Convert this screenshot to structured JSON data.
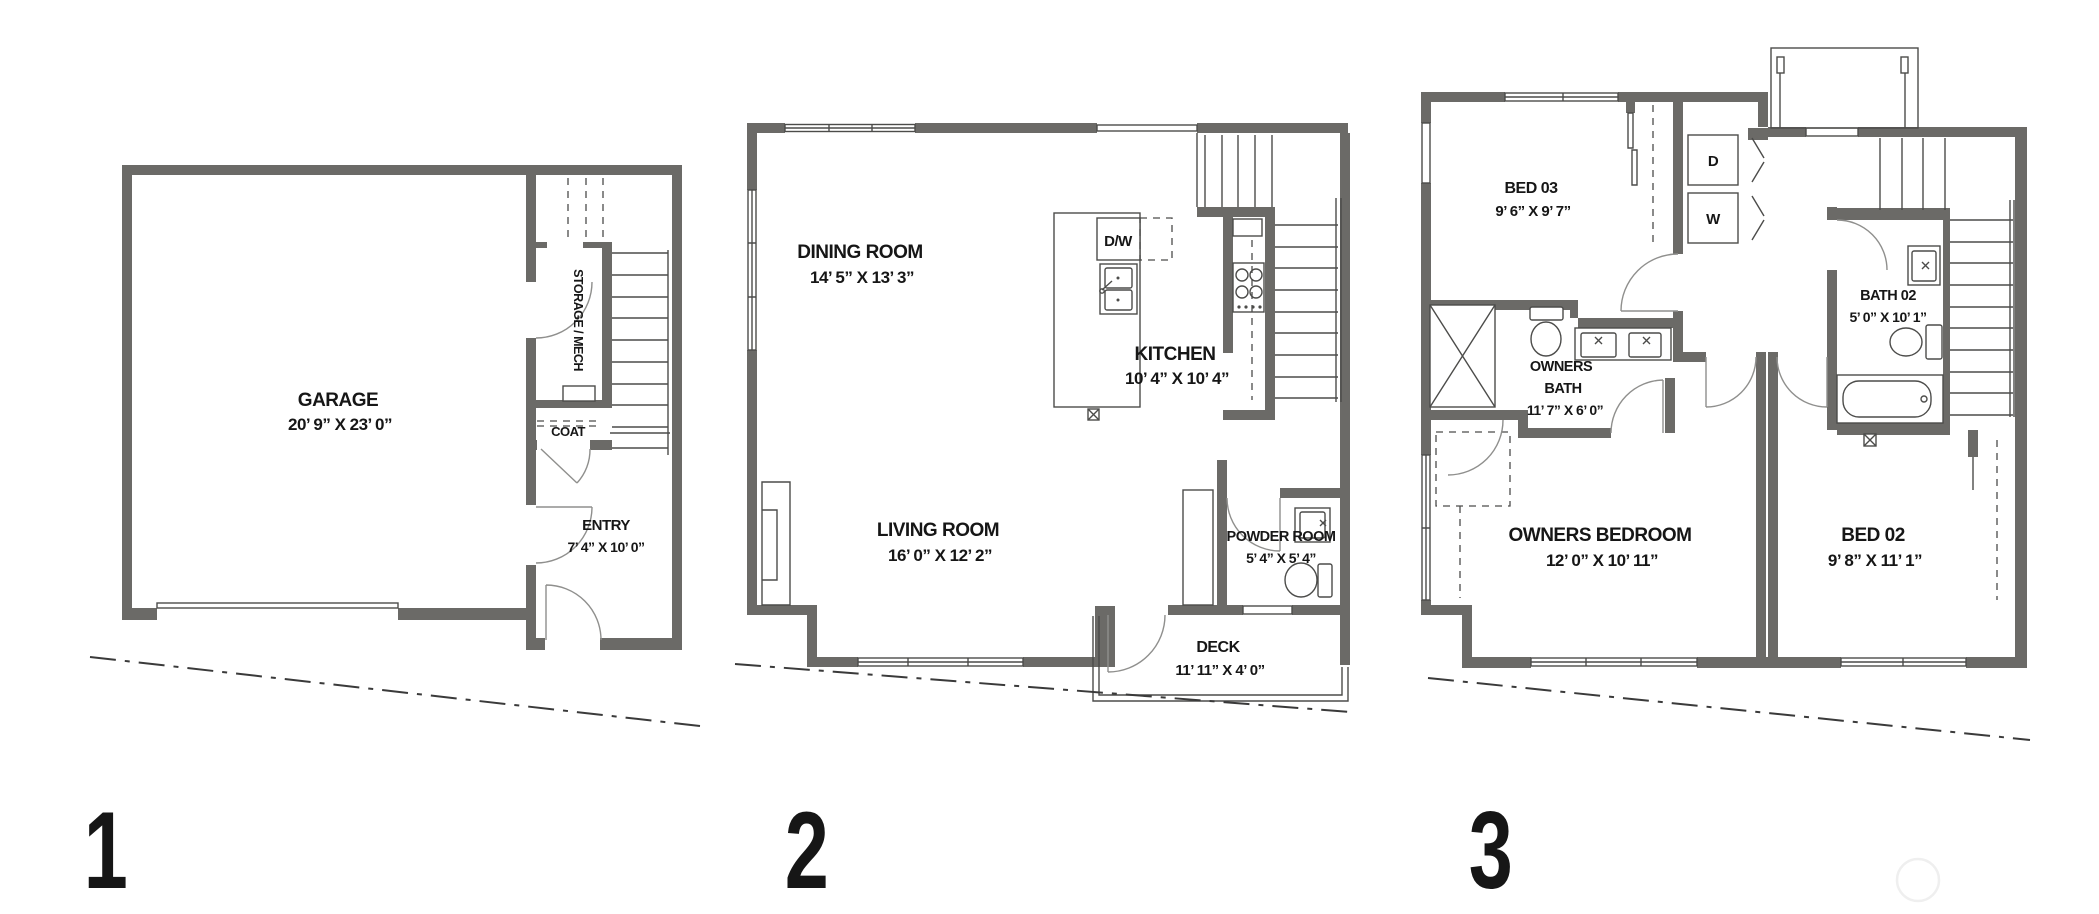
{
  "colors": {
    "wall": "#6b6a67",
    "thin_line": "#4c4c4a",
    "door_arc": "#8f8f8d",
    "text": "#161616",
    "property_line": "#3a3a3a",
    "watermark": "#efefef",
    "background": "#ffffff"
  },
  "floor1": {
    "number": "1",
    "garage": {
      "name": "GARAGE",
      "dims": "20’ 9” X 23’ 0”"
    },
    "storage": {
      "name": "STORAGE / MECH"
    },
    "coat": {
      "name": "COAT"
    },
    "entry": {
      "name": "ENTRY",
      "dims": "7’ 4” X 10’ 0”"
    }
  },
  "floor2": {
    "number": "2",
    "dining": {
      "name": "DINING ROOM",
      "dims": "14’ 5” X 13’ 3”"
    },
    "kitchen": {
      "name": "KITCHEN",
      "dims": "10’ 4” X 10’ 4”"
    },
    "living": {
      "name": "LIVING ROOM",
      "dims": "16’ 0” X 12’ 2”"
    },
    "powder": {
      "name": "POWDER ROOM",
      "dims": "5’ 4” X 5’ 4”"
    },
    "deck": {
      "name": "DECK",
      "dims": "11’ 11” X 4’ 0”"
    },
    "dishwasher": "D/W"
  },
  "floor3": {
    "number": "3",
    "bed03": {
      "name": "BED 03",
      "dims": "9’ 6” X 9’ 7”"
    },
    "bath02": {
      "name": "BATH 02",
      "dims": "5’ 0” X 10’ 1”"
    },
    "owners_bath": {
      "line1": "OWNERS",
      "line2": "BATH",
      "dims": "11’ 7” X 6’ 0”"
    },
    "owners_bedroom": {
      "name": "OWNERS BEDROOM",
      "dims": "12’ 0” X 10’ 11”"
    },
    "bed02": {
      "name": "BED 02",
      "dims": "9’ 8” X 11’ 1”"
    },
    "dryer": "D",
    "washer": "W"
  }
}
